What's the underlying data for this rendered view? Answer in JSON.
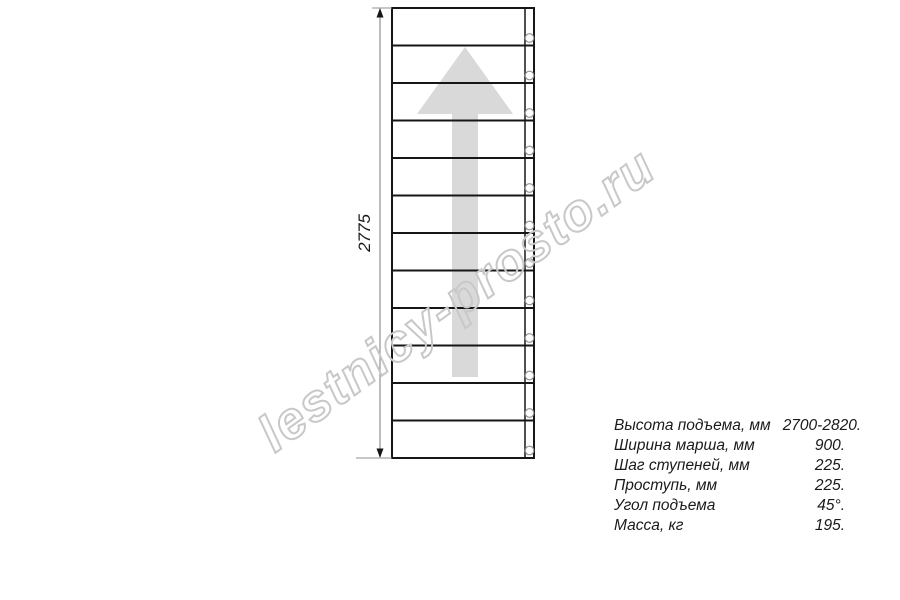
{
  "watermark": {
    "text": "lestnicy-prosto.ru",
    "color": "#c8c8c8"
  },
  "drawing": {
    "type": "staircase-plan-top-view",
    "dimension_label": "2775",
    "treads": 12,
    "balusters": 12,
    "arrow_color": "#d9d9d9",
    "line_color": "#161616",
    "dim_color": "#909090",
    "baluster_color": "#8f8f8f",
    "text_color": "#1a1a1a"
  },
  "specs": {
    "rows": [
      {
        "label": "Высота подъема, мм",
        "value": "2700-2820."
      },
      {
        "label": "Ширина марша, мм",
        "value": "900."
      },
      {
        "label": "Шаг ступеней, мм",
        "value": "225."
      },
      {
        "label": "Проступь, мм",
        "value": "225."
      },
      {
        "label": "Угол подъема",
        "value": "45°."
      },
      {
        "label": "Масса, кг",
        "value": "195."
      }
    ]
  }
}
